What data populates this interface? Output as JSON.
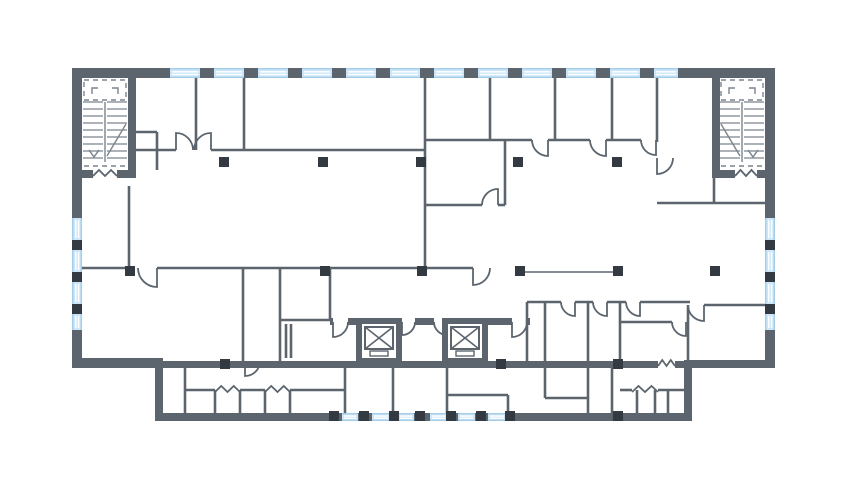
{
  "meta": {
    "description": "architectural-floor-plan",
    "canvas": {
      "width": 861,
      "height": 484
    }
  },
  "colors": {
    "background": "#ffffff",
    "wall": "#5c656e",
    "column": "#343a41",
    "window_fill": "#cde7f8",
    "window_stripe": "#ffffff",
    "window_frame": "#a4cdea",
    "stair_line": "#7b848d",
    "door_line": "#5c656e"
  },
  "plan": {
    "walls": [
      [
        72,
        68,
        703,
        10
      ],
      [
        72,
        78,
        10,
        290
      ],
      [
        72,
        358,
        91,
        10
      ],
      [
        155,
        358,
        8,
        55
      ],
      [
        155,
        413,
        537,
        8
      ],
      [
        684,
        368,
        8,
        45
      ],
      [
        684,
        360,
        91,
        8
      ],
      [
        765,
        78,
        10,
        282
      ],
      [
        128,
        68,
        8,
        110
      ],
      [
        72,
        170,
        21,
        8
      ],
      [
        117,
        170,
        19,
        8
      ],
      [
        712,
        68,
        8,
        110
      ],
      [
        712,
        170,
        23,
        8
      ],
      [
        757,
        170,
        18,
        8
      ],
      [
        163,
        361,
        495,
        7
      ],
      [
        675,
        361,
        9,
        7
      ],
      [
        330,
        318,
        3,
        7
      ],
      [
        348,
        318,
        10,
        7
      ],
      [
        415,
        318,
        19,
        7
      ],
      [
        488,
        318,
        24,
        7
      ],
      [
        527,
        318,
        3,
        7
      ]
    ],
    "partitions": [
      [
        196,
        78,
        196,
        150
      ],
      [
        244,
        78,
        244,
        150
      ],
      [
        136,
        150,
        176,
        150
      ],
      [
        211,
        150,
        425,
        150
      ],
      [
        425,
        78,
        425,
        268
      ],
      [
        490,
        78,
        490,
        140
      ],
      [
        555,
        78,
        555,
        140
      ],
      [
        612,
        78,
        612,
        140
      ],
      [
        657,
        78,
        657,
        142
      ],
      [
        425,
        140,
        532,
        140
      ],
      [
        548,
        140,
        590,
        140
      ],
      [
        606,
        140,
        641,
        140
      ],
      [
        425,
        205,
        482,
        205
      ],
      [
        498,
        205,
        505,
        205
      ],
      [
        505,
        140,
        505,
        205
      ],
      [
        657,
        203,
        767,
        203
      ],
      [
        129,
        186,
        129,
        268
      ],
      [
        82,
        268,
        135,
        268
      ],
      [
        157,
        268,
        473,
        268
      ],
      [
        243,
        268,
        243,
        361
      ],
      [
        280,
        268,
        280,
        361
      ],
      [
        330,
        268,
        330,
        320
      ],
      [
        280,
        320,
        330,
        320
      ],
      [
        286,
        324,
        286,
        358
      ],
      [
        291,
        324,
        291,
        358
      ],
      [
        527,
        302,
        561,
        302
      ],
      [
        575,
        302,
        593,
        302
      ],
      [
        607,
        302,
        626,
        302
      ],
      [
        640,
        302,
        690,
        302
      ],
      [
        527,
        302,
        527,
        361
      ],
      [
        545,
        302,
        545,
        361
      ],
      [
        588,
        302,
        588,
        361
      ],
      [
        620,
        302,
        620,
        361
      ],
      [
        620,
        322,
        672,
        322
      ],
      [
        688,
        305,
        688,
        361
      ],
      [
        704,
        305,
        767,
        305
      ],
      [
        714,
        178,
        714,
        203
      ],
      [
        136,
        132,
        157,
        132
      ],
      [
        157,
        132,
        157,
        170
      ],
      [
        185,
        368,
        185,
        413
      ],
      [
        345,
        368,
        345,
        413
      ],
      [
        185,
        390,
        215,
        390
      ],
      [
        240,
        390,
        265,
        390
      ],
      [
        290,
        390,
        345,
        390
      ],
      [
        215,
        390,
        215,
        413
      ],
      [
        240,
        390,
        240,
        413
      ],
      [
        265,
        390,
        265,
        413
      ],
      [
        290,
        390,
        290,
        413
      ],
      [
        393,
        368,
        393,
        413
      ],
      [
        447,
        368,
        447,
        413
      ],
      [
        447,
        395,
        508,
        395
      ],
      [
        508,
        395,
        508,
        413
      ],
      [
        545,
        368,
        545,
        398
      ],
      [
        545,
        398,
        588,
        398
      ],
      [
        588,
        368,
        588,
        413
      ],
      [
        612,
        368,
        612,
        413
      ],
      [
        620,
        390,
        632,
        390
      ],
      [
        658,
        390,
        684,
        390
      ],
      [
        637,
        390,
        637,
        413
      ],
      [
        655,
        390,
        655,
        413
      ],
      [
        668,
        390,
        668,
        413
      ]
    ],
    "windows": [
      {
        "x": 170,
        "y": 68,
        "w": 30,
        "h": 10,
        "o": "h"
      },
      {
        "x": 214,
        "y": 68,
        "w": 30,
        "h": 10,
        "o": "h"
      },
      {
        "x": 258,
        "y": 68,
        "w": 30,
        "h": 10,
        "o": "h"
      },
      {
        "x": 302,
        "y": 68,
        "w": 30,
        "h": 10,
        "o": "h"
      },
      {
        "x": 346,
        "y": 68,
        "w": 30,
        "h": 10,
        "o": "h"
      },
      {
        "x": 390,
        "y": 68,
        "w": 30,
        "h": 10,
        "o": "h"
      },
      {
        "x": 434,
        "y": 68,
        "w": 30,
        "h": 10,
        "o": "h"
      },
      {
        "x": 478,
        "y": 68,
        "w": 30,
        "h": 10,
        "o": "h"
      },
      {
        "x": 522,
        "y": 68,
        "w": 30,
        "h": 10,
        "o": "h"
      },
      {
        "x": 566,
        "y": 68,
        "w": 30,
        "h": 10,
        "o": "h"
      },
      {
        "x": 610,
        "y": 68,
        "w": 30,
        "h": 10,
        "o": "h"
      },
      {
        "x": 654,
        "y": 68,
        "w": 24,
        "h": 10,
        "o": "h"
      },
      {
        "x": 72,
        "y": 218,
        "w": 10,
        "h": 22,
        "o": "v"
      },
      {
        "x": 72,
        "y": 250,
        "w": 10,
        "h": 22,
        "o": "v"
      },
      {
        "x": 72,
        "y": 282,
        "w": 10,
        "h": 22,
        "o": "v"
      },
      {
        "x": 72,
        "y": 314,
        "w": 10,
        "h": 16,
        "o": "v"
      },
      {
        "x": 765,
        "y": 218,
        "w": 10,
        "h": 22,
        "o": "v"
      },
      {
        "x": 765,
        "y": 250,
        "w": 10,
        "h": 22,
        "o": "v"
      },
      {
        "x": 765,
        "y": 282,
        "w": 10,
        "h": 22,
        "o": "v"
      },
      {
        "x": 765,
        "y": 314,
        "w": 10,
        "h": 16,
        "o": "v"
      },
      {
        "x": 342,
        "y": 413,
        "w": 16,
        "h": 8,
        "o": "h"
      },
      {
        "x": 372,
        "y": 413,
        "w": 18,
        "h": 8,
        "o": "h"
      },
      {
        "x": 398,
        "y": 413,
        "w": 16,
        "h": 8,
        "o": "h"
      },
      {
        "x": 430,
        "y": 413,
        "w": 17,
        "h": 8,
        "o": "h"
      },
      {
        "x": 458,
        "y": 413,
        "w": 17,
        "h": 8,
        "o": "h"
      },
      {
        "x": 488,
        "y": 413,
        "w": 18,
        "h": 8,
        "o": "h"
      }
    ],
    "columns": [
      [
        219,
        157
      ],
      [
        318,
        157
      ],
      [
        416,
        157
      ],
      [
        513,
        157
      ],
      [
        612,
        157
      ],
      [
        125,
        266
      ],
      [
        320,
        266
      ],
      [
        417,
        266
      ],
      [
        515,
        266
      ],
      [
        613,
        266
      ],
      [
        710,
        266
      ],
      [
        220,
        359
      ],
      [
        496,
        359
      ],
      [
        613,
        359
      ],
      [
        329,
        411
      ],
      [
        359,
        411
      ],
      [
        389,
        411
      ],
      [
        415,
        411
      ],
      [
        446,
        411
      ],
      [
        476,
        411
      ],
      [
        505,
        411
      ],
      [
        613,
        411
      ],
      [
        72,
        240
      ],
      [
        72,
        272
      ],
      [
        72,
        304
      ],
      [
        765,
        240
      ],
      [
        765,
        272
      ],
      [
        765,
        304
      ]
    ],
    "screens": [
      [
        523,
        272,
        613,
        272
      ]
    ],
    "counters": [
      [
        188,
        416,
        342,
        416
      ],
      [
        622,
        416,
        682,
        416
      ]
    ],
    "stairs": [
      {
        "x": 82,
        "y": 78,
        "w": 46,
        "h": 100,
        "dir": 1
      },
      {
        "x": 719,
        "y": 78,
        "w": 46,
        "h": 100,
        "dir": -1
      }
    ],
    "elevators": [
      {
        "x": 356,
        "y": 318,
        "w": 46,
        "h": 44
      },
      {
        "x": 442,
        "y": 318,
        "w": 46,
        "h": 44
      }
    ],
    "doors": [
      [
        176,
        150,
        17,
        "n",
        "e"
      ],
      [
        211,
        150,
        17,
        "n",
        "w"
      ],
      [
        548,
        140,
        16,
        "s",
        "w"
      ],
      [
        606,
        140,
        16,
        "s",
        "w"
      ],
      [
        656,
        140,
        15,
        "s",
        "w"
      ],
      [
        498,
        205,
        16,
        "n",
        "w"
      ],
      [
        657,
        158,
        16,
        "s",
        "e"
      ],
      [
        157,
        268,
        19,
        "s",
        "w"
      ],
      [
        473,
        268,
        17,
        "s",
        "e"
      ],
      [
        333,
        322,
        15,
        "s",
        "e"
      ],
      [
        402,
        322,
        13,
        "s",
        "e"
      ],
      [
        447,
        322,
        13,
        "s",
        "w"
      ],
      [
        512,
        322,
        15,
        "s",
        "e"
      ],
      [
        575,
        302,
        14,
        "s",
        "w"
      ],
      [
        607,
        302,
        14,
        "s",
        "w"
      ],
      [
        640,
        302,
        14,
        "s",
        "w"
      ],
      [
        686,
        322,
        14,
        "s",
        "w"
      ],
      [
        704,
        305,
        16,
        "s",
        "w"
      ],
      [
        245,
        361,
        15,
        "s",
        "e"
      ]
    ],
    "breaks": [
      [
        93,
        176,
        24
      ],
      [
        735,
        176,
        22
      ],
      [
        658,
        366,
        17
      ],
      [
        215,
        392,
        25
      ],
      [
        265,
        392,
        25
      ],
      [
        632,
        392,
        26
      ]
    ]
  }
}
